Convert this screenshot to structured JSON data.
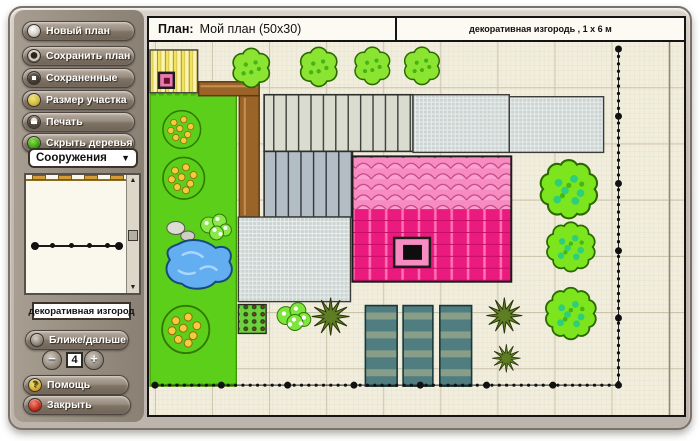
{
  "topbar": {
    "plan_prefix": "План:",
    "plan_name": "Мой план (50x30)",
    "selected_item_label": "декоративная изгородь ,  1 х 6 м"
  },
  "sidebar": {
    "buttons": [
      {
        "label": "Новый план",
        "icon": "new-plan-icon"
      },
      {
        "label": "Сохранить план",
        "icon": "save-plan-icon"
      },
      {
        "label": "Сохраненные",
        "icon": "saved-plans-icon"
      },
      {
        "label": "Размер участка",
        "icon": "plot-size-icon"
      },
      {
        "label": "Печать",
        "icon": "print-icon"
      },
      {
        "label": "Скрыть деревья",
        "icon": "hide-trees-icon"
      }
    ],
    "structures_dropdown": {
      "value": "Сооружения",
      "arrow": "▼"
    },
    "preview_scrollbar": {
      "up": "▲",
      "down": "▼"
    },
    "preview_caption": "декоративная изгород",
    "zoom": {
      "label": "Ближе/дальше",
      "minus": "−",
      "value": "4",
      "plus": "+"
    },
    "help_label": "Помощь",
    "close_label": "Закрыть"
  },
  "colors": {
    "window_frame": "#c3bbb3",
    "sidebar_strip": "#968c80",
    "canvas_bg": "#f2eedd",
    "lawn_green": "#5ccf1a",
    "tree_green": "#7de51e",
    "pond_blue": "#62aef0",
    "house_roof_light_pink": "#f78cc2",
    "house_roof_magenta": "#ea1a7e",
    "pergola_brown": "#9a6428",
    "shed_yellow": "#f0e35e",
    "paved_gray": "#ccd4d3",
    "veg_bed_teal": "#507d80",
    "fence_dot_black": "#111111"
  }
}
